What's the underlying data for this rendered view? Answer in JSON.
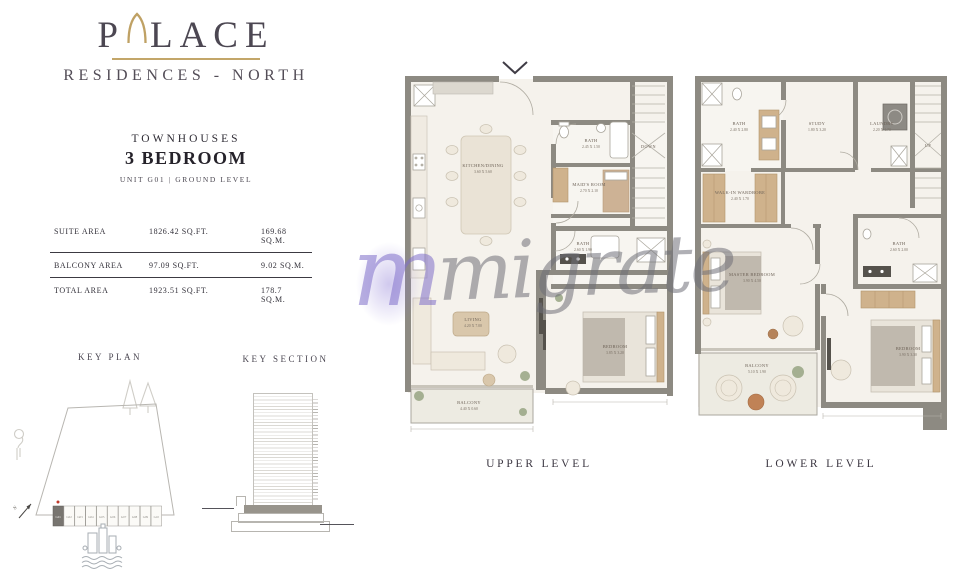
{
  "colors": {
    "gold": "#c3a669",
    "wall_gray": "#8d8a82",
    "highlighted_unit_fill": "#787570",
    "unit_marker_red": "#c0392b"
  },
  "brand": {
    "word_start": "P",
    "word_end": "LACE",
    "arch_icon": "pointed-arch-icon",
    "subtitle": "RESIDENCES - NORTH"
  },
  "header": {
    "category": "TOWNHOUSES",
    "title": "3 BEDROOM",
    "unit_info": "UNIT G01  |  GROUND LEVEL"
  },
  "area_table": {
    "rows": [
      {
        "label": "SUITE AREA",
        "sqft": "1826.42 SQ.FT.",
        "sqm": "169.68 SQ.M."
      },
      {
        "label": "BALCONY AREA",
        "sqft": "97.09 SQ.FT.",
        "sqm": "9.02 SQ.M."
      },
      {
        "label": "TOTAL AREA",
        "sqft": "1923.51 SQ.FT.",
        "sqm": "178.7  SQ.M."
      }
    ]
  },
  "key_plan": {
    "title": "KEY PLAN",
    "north_label": "N",
    "units": [
      "G01",
      "G02",
      "G03",
      "G04",
      "G05",
      "G06",
      "G07",
      "G08",
      "G09",
      "G10"
    ],
    "highlighted_unit": "G01"
  },
  "key_section": {
    "title": "KEY SECTION"
  },
  "upper_plan": {
    "caption": "UPPER LEVEL",
    "stairs_label": "DOWN",
    "rooms": {
      "kitchen_dining": {
        "name": "KITCHEN/DINING",
        "dims": "3.60 X 5.60"
      },
      "bath_top": {
        "name": "BATH",
        "dims": "2.45 X 1.50"
      },
      "maids_room": {
        "name": "MAID'S ROOM",
        "dims": "2.70 X 2.10"
      },
      "bath_mid": {
        "name": "BATH",
        "dims": "2.60 X 1.90"
      },
      "living": {
        "name": "LIVING",
        "dims": "4.20 X 7.00"
      },
      "bedroom": {
        "name": "BEDROOM",
        "dims": "3.85 X 3.20"
      },
      "balcony": {
        "name": "BALCONY",
        "dims": "4.40 X 0.60"
      }
    }
  },
  "lower_plan": {
    "caption": "LOWER LEVEL",
    "stairs_label": "UP",
    "rooms": {
      "bath_top": {
        "name": "BATH",
        "dims": "2.40 X 2.80"
      },
      "study": {
        "name": "STUDY",
        "dims": "1.80 X 3.20"
      },
      "laundry": {
        "name": "LAUNDRY",
        "dims": "2.20 X 1.70"
      },
      "walk_in_wardrobe": {
        "name": "WALK-IN WARDROBE",
        "dims": "2.40 X 1.70"
      },
      "master_bedroom": {
        "name": "MASTER BEDROOM",
        "dims": "3.90 X 4.50"
      },
      "bath_right": {
        "name": "BATH",
        "dims": "2.60 X 2.00"
      },
      "bedroom": {
        "name": "BEDROOM",
        "dims": "3.90 X 3.30"
      },
      "balcony": {
        "name": "BALCONY",
        "dims": "5.10 X 1.90"
      }
    }
  },
  "watermark": {
    "logo_letter": "m",
    "text": "migrate"
  }
}
